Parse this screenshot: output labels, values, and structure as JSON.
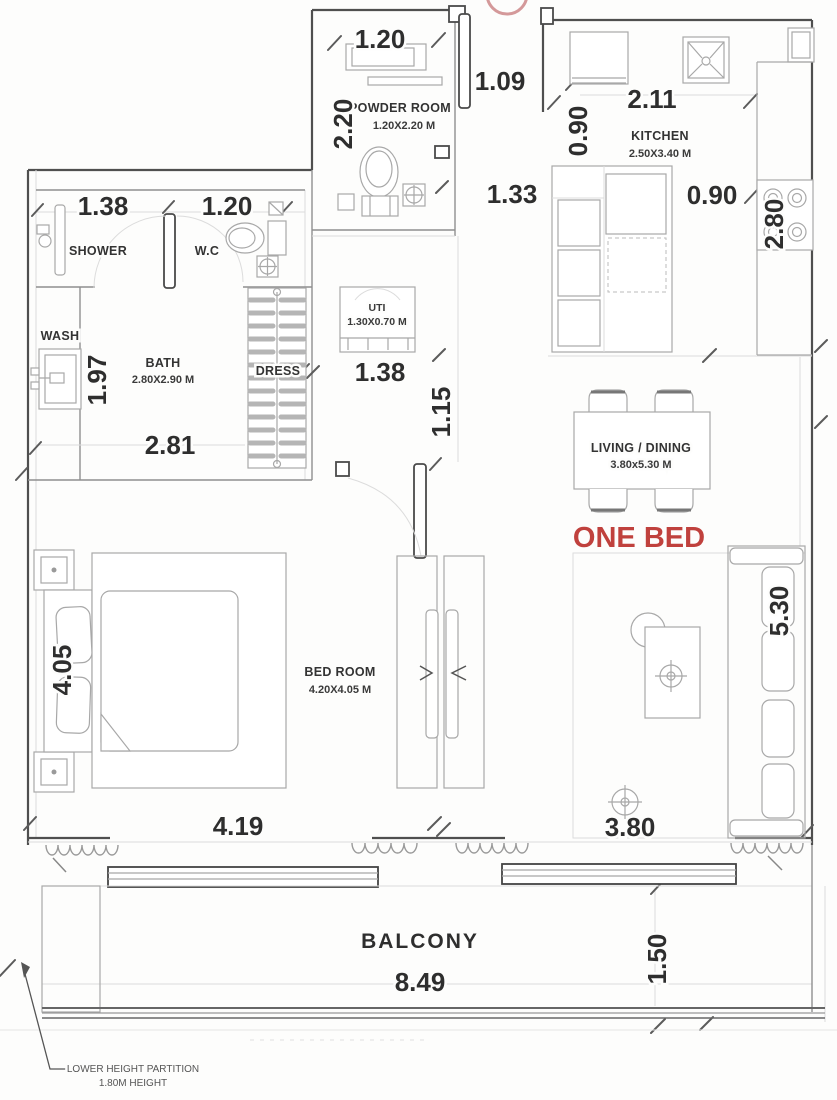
{
  "plan": {
    "unit_label": "ONE BED",
    "note_line1": "LOWER HEIGHT PARTITION",
    "note_line2": "1.80M HEIGHT",
    "colors": {
      "accent_red": "#c0413d",
      "wall": "#4f4f4f",
      "line": "#8f8f8f",
      "text": "#2e2e2e"
    },
    "rooms": {
      "powder_room": {
        "name": "POWDER ROOM",
        "size": "1.20X2.20 M"
      },
      "kitchen": {
        "name": "KITCHEN",
        "size": "2.50X3.40 M"
      },
      "shower": {
        "name": "SHOWER"
      },
      "wc": {
        "name": "W.C"
      },
      "wash": {
        "name": "WASH"
      },
      "bath": {
        "name": "BATH",
        "size": "2.80X2.90 M"
      },
      "dress": {
        "name": "DRESS"
      },
      "uti": {
        "name": "UTI",
        "size": "1.30X0.70 M"
      },
      "living_dining": {
        "name": "LIVING / DINING",
        "size": "3.80x5.30 M"
      },
      "bedroom": {
        "name": "BED ROOM",
        "size": "4.20X4.05 M"
      },
      "balcony": {
        "name": "BALCONY"
      }
    },
    "dimensions": {
      "powder_width": "1.20",
      "entry_door": "1.09",
      "kitchen_width": "2.11",
      "kitchen_entry": "0.90",
      "powder_depth": "2.20",
      "hall_width": "1.33",
      "counter_clearance": "0.90",
      "counter_run": "2.80",
      "shower_width": "1.38",
      "wc_width": "1.20",
      "wash_run": "1.97",
      "bath_width": "2.81",
      "uti_width": "1.38",
      "corridor_width": "1.15",
      "bedroom_depth": "4.05",
      "bedroom_width": "4.19",
      "living_depth": "5.30",
      "living_width": "3.80",
      "balcony_width": "8.49",
      "balcony_depth": "1.50"
    }
  }
}
